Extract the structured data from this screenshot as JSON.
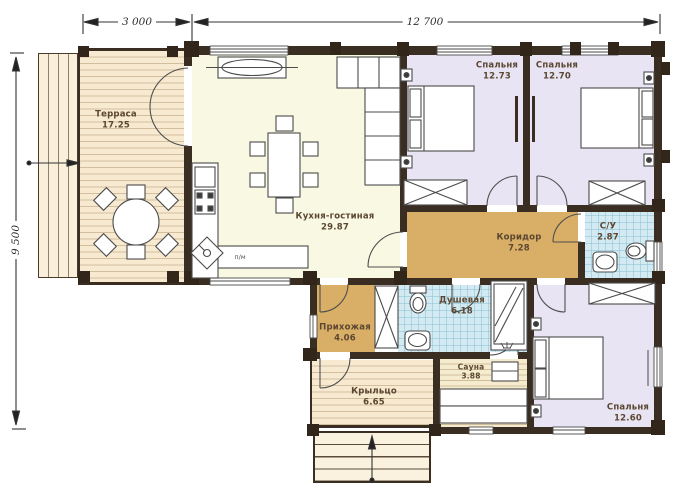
{
  "dimensions": {
    "top_small": "3 000",
    "top_large": "12 700",
    "left": "9 500"
  },
  "rooms": {
    "terrace": {
      "name": "Терраса",
      "area": "17.25"
    },
    "kitchen_living": {
      "name": "Кухня-гостиная",
      "area": "29.87"
    },
    "bedroom_1": {
      "name": "Спальня",
      "area": "12.73"
    },
    "bedroom_2": {
      "name": "Спальня",
      "area": "12.70"
    },
    "corridor": {
      "name": "Коридор",
      "area": "7.28"
    },
    "bathroom": {
      "name": "С/У",
      "area": "2.87"
    },
    "shower_room": {
      "name": "Душевая",
      "area": "6.18"
    },
    "hallway": {
      "name": "Прихожая",
      "area": "4.06"
    },
    "sauna": {
      "name": "Сауна",
      "area": "3.88"
    },
    "porch": {
      "name": "Крыльцо",
      "area": "6.65"
    },
    "bedroom_3": {
      "name": "Спальня",
      "area": "12.60"
    }
  },
  "annotations": {
    "dishwasher": "п/м"
  },
  "colors": {
    "wall": "#3a2d21",
    "terrace_floor": "#f7ead1",
    "kitchen_floor": "#f9f8e2",
    "bedroom_floor": "#e8e4f3",
    "corridor_floor": "#d9ae67",
    "wet_room_floor": "#d3eaf2",
    "sauna_floor": "#f5ecd0"
  }
}
